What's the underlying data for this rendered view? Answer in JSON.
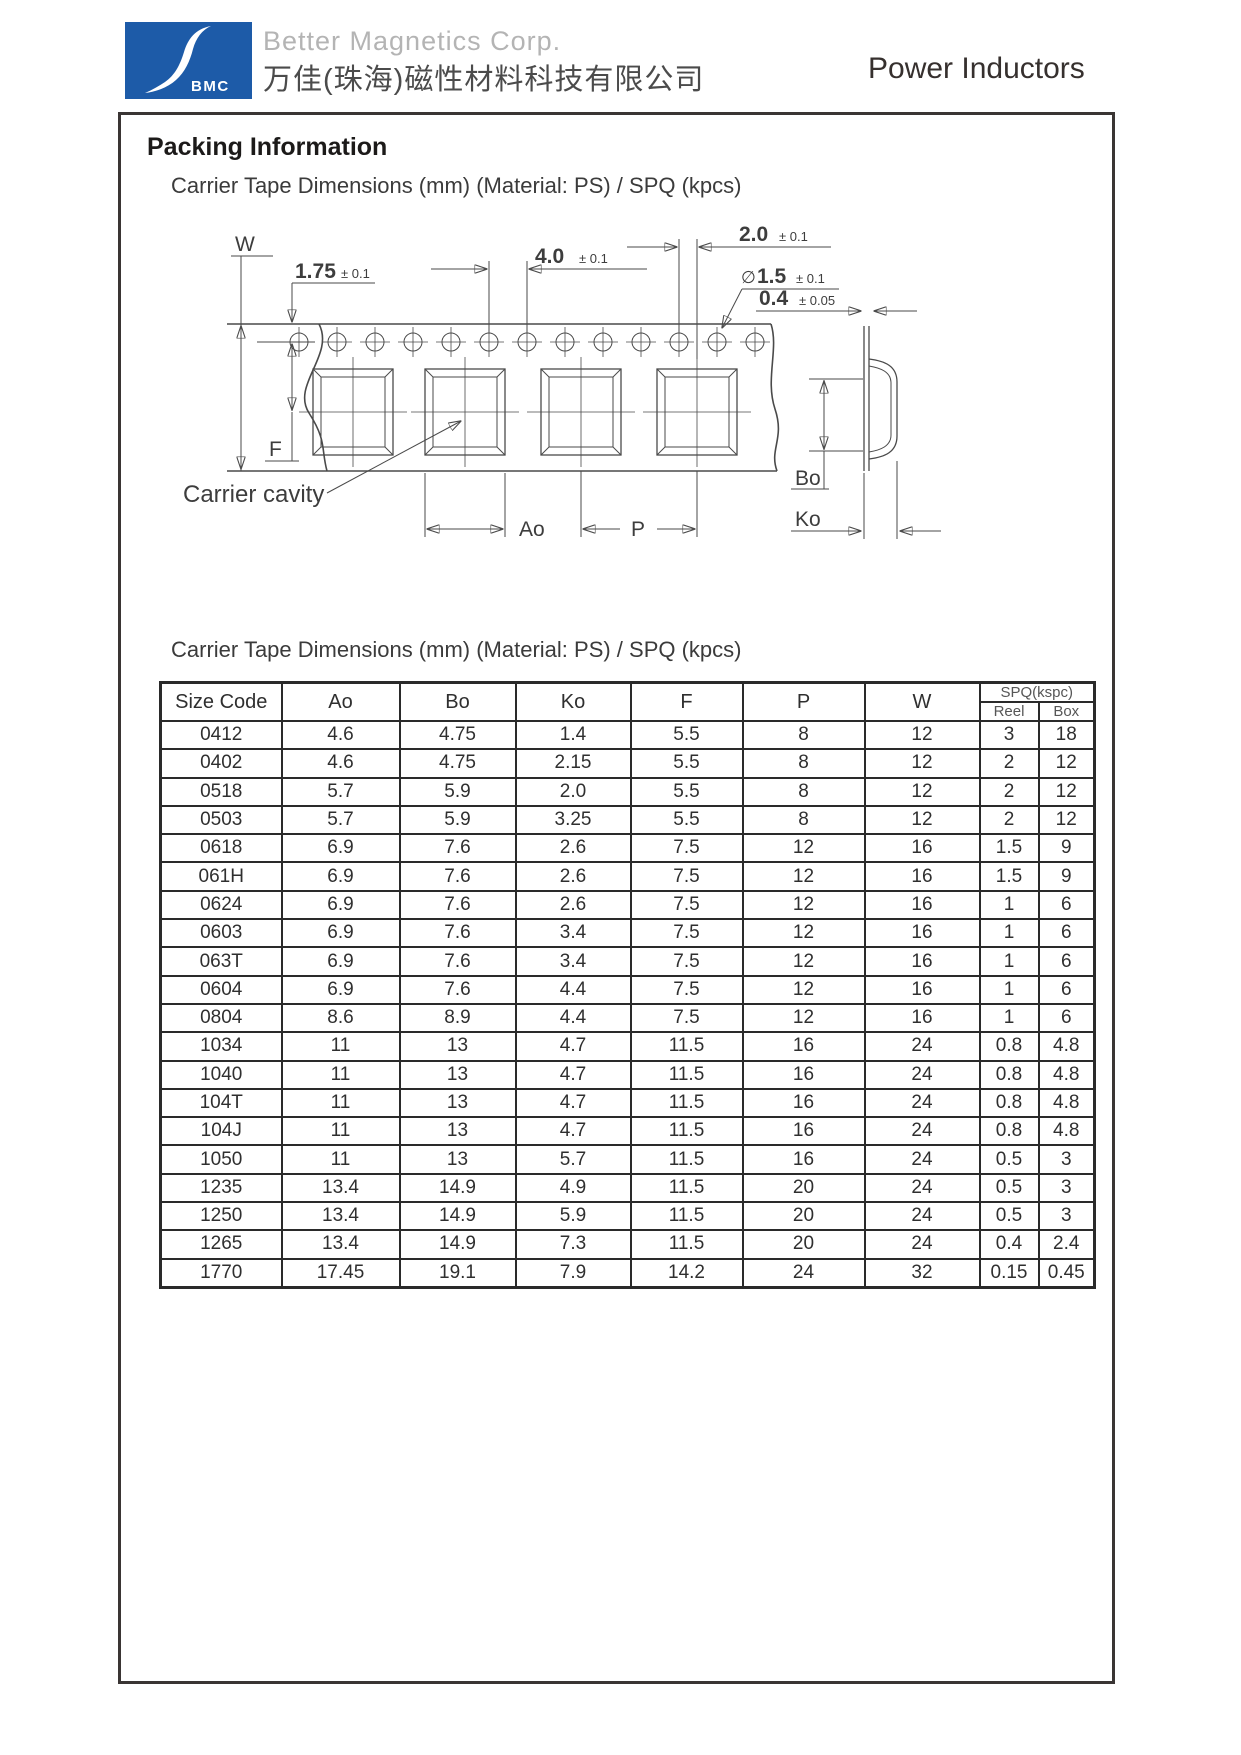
{
  "header": {
    "logo_text": "BMC",
    "company_en": "Better Magnetics Corp.",
    "company_zh": "万佳(珠海)磁性材料科技有限公司",
    "product_line": "Power Inductors",
    "logo_color": "#1d5ba8"
  },
  "page": {
    "section_title": "Packing Information",
    "subtitle": "Carrier Tape Dimensions (mm) (Material: PS) / SPQ (kpcs)",
    "table_title": "Carrier Tape Dimensions (mm) (Material: PS) / SPQ (kpcs)"
  },
  "diagram": {
    "labels": {
      "w": "W",
      "f": "F",
      "ao": "Ao",
      "p": "P",
      "bo": "Bo",
      "ko": "Ko",
      "carrier_cavity": "Carrier cavity",
      "sprocket_edge": "1.75",
      "sprocket_edge_tol": "± 0.1",
      "hole_pitch": "4.0",
      "hole_pitch_tol": "± 0.1",
      "hole_to_cavity": "2.0",
      "hole_to_cavity_tol": "± 0.1",
      "dia_symbol": "∅",
      "hole_dia": "1.5",
      "hole_dia_tol": "± 0.1",
      "thickness": "0.4",
      "thickness_tol": "± 0.05"
    }
  },
  "table": {
    "columns": [
      "Size Code",
      "Ao",
      "Bo",
      "Ko",
      "F",
      "P",
      "W"
    ],
    "spq_header": "SPQ(kspc)",
    "spq_sub": [
      "Reel",
      "Box"
    ],
    "rows": [
      [
        "0412",
        "4.6",
        "4.75",
        "1.4",
        "5.5",
        "8",
        "12",
        "3",
        "18"
      ],
      [
        "0402",
        "4.6",
        "4.75",
        "2.15",
        "5.5",
        "8",
        "12",
        "2",
        "12"
      ],
      [
        "0518",
        "5.7",
        "5.9",
        "2.0",
        "5.5",
        "8",
        "12",
        "2",
        "12"
      ],
      [
        "0503",
        "5.7",
        "5.9",
        "3.25",
        "5.5",
        "8",
        "12",
        "2",
        "12"
      ],
      [
        "0618",
        "6.9",
        "7.6",
        "2.6",
        "7.5",
        "12",
        "16",
        "1.5",
        "9"
      ],
      [
        "061H",
        "6.9",
        "7.6",
        "2.6",
        "7.5",
        "12",
        "16",
        "1.5",
        "9"
      ],
      [
        "0624",
        "6.9",
        "7.6",
        "2.6",
        "7.5",
        "12",
        "16",
        "1",
        "6"
      ],
      [
        "0603",
        "6.9",
        "7.6",
        "3.4",
        "7.5",
        "12",
        "16",
        "1",
        "6"
      ],
      [
        "063T",
        "6.9",
        "7.6",
        "3.4",
        "7.5",
        "12",
        "16",
        "1",
        "6"
      ],
      [
        "0604",
        "6.9",
        "7.6",
        "4.4",
        "7.5",
        "12",
        "16",
        "1",
        "6"
      ],
      [
        "0804",
        "8.6",
        "8.9",
        "4.4",
        "7.5",
        "12",
        "16",
        "1",
        "6"
      ],
      [
        "1034",
        "11",
        "13",
        "4.7",
        "11.5",
        "16",
        "24",
        "0.8",
        "4.8"
      ],
      [
        "1040",
        "11",
        "13",
        "4.7",
        "11.5",
        "16",
        "24",
        "0.8",
        "4.8"
      ],
      [
        "104T",
        "11",
        "13",
        "4.7",
        "11.5",
        "16",
        "24",
        "0.8",
        "4.8"
      ],
      [
        "104J",
        "11",
        "13",
        "4.7",
        "11.5",
        "16",
        "24",
        "0.8",
        "4.8"
      ],
      [
        "1050",
        "11",
        "13",
        "5.7",
        "11.5",
        "16",
        "24",
        "0.5",
        "3"
      ],
      [
        "1235",
        "13.4",
        "14.9",
        "4.9",
        "11.5",
        "20",
        "24",
        "0.5",
        "3"
      ],
      [
        "1250",
        "13.4",
        "14.9",
        "5.9",
        "11.5",
        "20",
        "24",
        "0.5",
        "3"
      ],
      [
        "1265",
        "13.4",
        "14.9",
        "7.3",
        "11.5",
        "20",
        "24",
        "0.4",
        "2.4"
      ],
      [
        "1770",
        "17.45",
        "19.1",
        "7.9",
        "14.2",
        "24",
        "32",
        "0.15",
        "0.45"
      ]
    ]
  }
}
